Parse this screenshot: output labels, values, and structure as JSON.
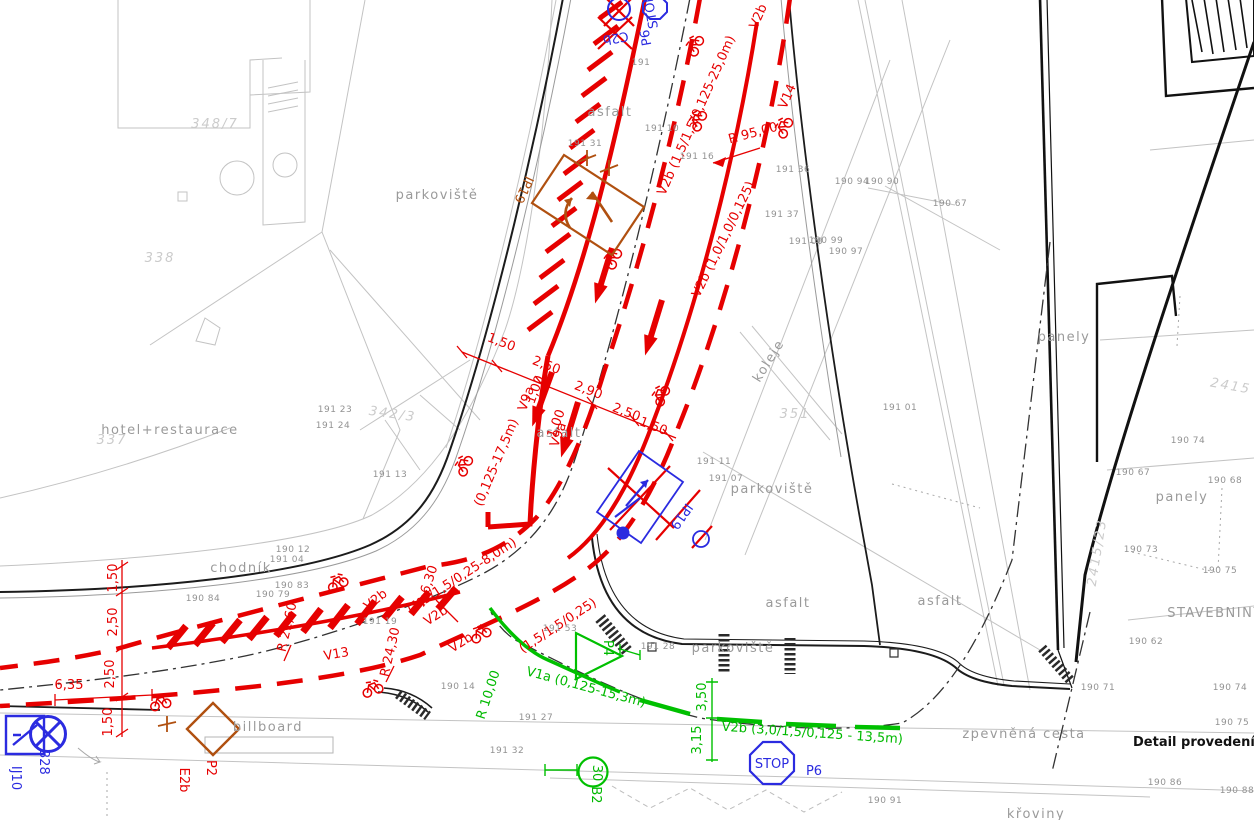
{
  "drawing": {
    "type": "traffic-engineering-situation-plan",
    "detail_note": "Detail provedení symbolu"
  },
  "colors": {
    "new_marking_red": "#e60000",
    "new_marking_green": "#00b900",
    "existing_sign_blue": "#2b2be0",
    "sign_brown": "#b05010",
    "cadastre_gray": "#9a9a9a",
    "parcel_gray": "#cbcbcb",
    "road_black": "#1c1c1c"
  },
  "labels": [
    {
      "id": "surface-chodnik",
      "text": "chodník",
      "x": 241,
      "y": 572,
      "cls": "g",
      "size": 13
    },
    {
      "id": "surface-parkoviste-1",
      "text": "parkoviště",
      "x": 437,
      "y": 199,
      "cls": "g",
      "size": 13
    },
    {
      "id": "surface-parkoviste-2",
      "text": "parkoviště",
      "x": 772,
      "y": 493,
      "cls": "g",
      "size": 13
    },
    {
      "id": "surface-parkoviste-3",
      "text": "parkoviště",
      "x": 733,
      "y": 652,
      "cls": "g",
      "size": 12
    },
    {
      "id": "surface-asfalt-1",
      "text": "asfalt",
      "x": 610,
      "y": 116,
      "cls": "g",
      "size": 13
    },
    {
      "id": "surface-asfalt-2",
      "text": "asfalt",
      "x": 559,
      "y": 437,
      "cls": "g",
      "size": 13
    },
    {
      "id": "surface-asfalt-3",
      "text": "asfalt",
      "x": 788,
      "y": 607,
      "cls": "g",
      "size": 13
    },
    {
      "id": "surface-asfalt-4",
      "text": "asfalt",
      "x": 940,
      "y": 605,
      "cls": "g",
      "size": 13
    },
    {
      "id": "surface-koleje",
      "text": "koleje",
      "x": 772,
      "y": 363,
      "rot": -58,
      "cls": "g",
      "size": 13
    },
    {
      "id": "surface-billboard",
      "text": "billboard",
      "x": 268,
      "y": 731,
      "cls": "g",
      "size": 12
    },
    {
      "id": "surface-panely-1",
      "text": "panely",
      "x": 1064,
      "y": 341,
      "cls": "g",
      "size": 12
    },
    {
      "id": "surface-panely-2",
      "text": "panely",
      "x": 1182,
      "y": 501,
      "cls": "g",
      "size": 12
    },
    {
      "id": "surface-stavebniny",
      "text": "STAVEBNINY",
      "x": 1215,
      "y": 617,
      "cls": "g",
      "size": 12
    },
    {
      "id": "surface-zpevnena-cesta",
      "text": "zpevněná cesta",
      "x": 1024,
      "y": 738,
      "cls": "g",
      "size": 13
    },
    {
      "id": "surface-kroviny",
      "text": "křoviny",
      "x": 1036,
      "y": 818,
      "cls": "g",
      "size": 13
    },
    {
      "id": "surface-hotel",
      "text": "hotel+restaurace",
      "x": 170,
      "y": 434,
      "cls": "g",
      "size": 11
    },
    {
      "id": "detail-note",
      "text": "Detail provedení symbolu",
      "x": 1133,
      "y": 746,
      "cls": "k",
      "size": 14,
      "anchor": "start"
    },
    {
      "id": "parcel-338",
      "text": "338",
      "x": 160,
      "y": 262,
      "cls": "p",
      "size": 42
    },
    {
      "id": "parcel-348-7",
      "text": "348/7",
      "x": 215,
      "y": 128,
      "cls": "p",
      "size": 42
    },
    {
      "id": "parcel-342-3",
      "text": "342/3",
      "x": 392,
      "y": 418,
      "rot": 8,
      "cls": "p",
      "size": 38
    },
    {
      "id": "parcel-337",
      "text": "337",
      "x": 112,
      "y": 444,
      "cls": "p",
      "size": 42
    },
    {
      "id": "parcel-351",
      "text": "351",
      "x": 795,
      "y": 418,
      "cls": "p",
      "size": 46
    },
    {
      "id": "parcel-2415",
      "text": "2415",
      "x": 1230,
      "y": 390,
      "rot": 10,
      "cls": "p",
      "size": 42
    },
    {
      "id": "parcel-2415-23",
      "text": "2415/23",
      "x": 1101,
      "y": 553,
      "rot": -81,
      "cls": "p",
      "size": 36
    },
    {
      "id": "mark-v2b-top",
      "text": "V2b",
      "x": 762,
      "y": 18,
      "rot": -66,
      "cls": "r",
      "size": 17
    },
    {
      "id": "mark-v14",
      "text": "V14",
      "x": 791,
      "y": 98,
      "rot": -66,
      "cls": "r",
      "size": 19
    },
    {
      "id": "dim-r95",
      "text": "R 95,00",
      "x": 754,
      "y": 137,
      "rot": -15,
      "cls": "r",
      "size": 17
    },
    {
      "id": "mark-v2b-25m",
      "text": "V2b (1,5/1,5/0,125-25,0m)",
      "x": 700,
      "y": 117,
      "rot": -66,
      "cls": "r",
      "size": 15
    },
    {
      "id": "mark-v2b-10",
      "text": "V2b (1,0/1,0/0,125)",
      "x": 727,
      "y": 241,
      "rot": -64,
      "cls": "r",
      "size": 15
    },
    {
      "id": "mark-v9a-1",
      "text": "V9a",
      "x": 530,
      "y": 400,
      "rot": -70,
      "cls": "r",
      "size": 14
    },
    {
      "id": "mark-v9a-2",
      "text": "V9a",
      "x": 562,
      "y": 436,
      "rot": -70,
      "cls": "r",
      "size": 14
    },
    {
      "id": "dim-150-a",
      "text": "1,50",
      "x": 500,
      "y": 346,
      "rot": 21,
      "cls": "r",
      "size": 15
    },
    {
      "id": "dim-250-a",
      "text": "2,50",
      "x": 545,
      "y": 369,
      "rot": 21,
      "cls": "r",
      "size": 15
    },
    {
      "id": "dim-290",
      "text": "2,90",
      "x": 587,
      "y": 394,
      "rot": 21,
      "cls": "r",
      "size": 15
    },
    {
      "id": "dim-250-b",
      "text": "2,50",
      "x": 625,
      "y": 416,
      "rot": 21,
      "cls": "r",
      "size": 15
    },
    {
      "id": "dim-150-b",
      "text": "1,50",
      "x": 652,
      "y": 430,
      "rot": 21,
      "cls": "r",
      "size": 15
    },
    {
      "id": "dim-100-a",
      "text": "1,00",
      "x": 539,
      "y": 391,
      "rot": -70,
      "cls": "r",
      "size": 11
    },
    {
      "id": "dim-100-b",
      "text": "1,00",
      "x": 560,
      "y": 425,
      "rot": -70,
      "cls": "r",
      "size": 11
    },
    {
      "id": "mark-0125-175",
      "text": "(0,125-17,5m)",
      "x": 500,
      "y": 464,
      "rot": -67,
      "cls": "r",
      "size": 15
    },
    {
      "id": "mark-v2b-8m",
      "text": "(1,5/1,5/0,25-8,0m)",
      "x": 464,
      "y": 579,
      "rot": -33,
      "cls": "r",
      "size": 15
    },
    {
      "id": "mark-v2b-a",
      "text": "V2b",
      "x": 378,
      "y": 603,
      "rot": -38,
      "cls": "r",
      "size": 16
    },
    {
      "id": "mark-v2b-b",
      "text": "V2b",
      "x": 438,
      "y": 619,
      "rot": -33,
      "cls": "r",
      "size": 16
    },
    {
      "id": "mark-v2b-c",
      "text": "V2b",
      "x": 463,
      "y": 646,
      "rot": -33,
      "cls": "r",
      "size": 16
    },
    {
      "id": "mark-v2b-d",
      "text": "(1,5/1,5/0,25)",
      "x": 560,
      "y": 629,
      "rot": -33,
      "cls": "r",
      "size": 15
    },
    {
      "id": "dim-r630",
      "text": "R 6,30",
      "x": 431,
      "y": 587,
      "rot": -72,
      "cls": "r",
      "size": 15
    },
    {
      "id": "dim-r2160",
      "text": "R 21,60",
      "x": 291,
      "y": 628,
      "rot": -77,
      "cls": "r",
      "size": 15
    },
    {
      "id": "dim-r2430",
      "text": "R 24,30",
      "x": 394,
      "y": 653,
      "rot": -77,
      "cls": "r",
      "size": 15
    },
    {
      "id": "mark-v13",
      "text": "V13",
      "x": 337,
      "y": 658,
      "rot": -10,
      "cls": "r",
      "size": 17
    },
    {
      "id": "dim-left-150-a",
      "text": "1,50",
      "x": 117,
      "y": 578,
      "rot": -90,
      "cls": "r",
      "size": 14
    },
    {
      "id": "dim-left-250-a",
      "text": "2,50",
      "x": 117,
      "y": 622,
      "rot": -90,
      "cls": "r",
      "size": 14
    },
    {
      "id": "dim-left-250-b",
      "text": "2,50",
      "x": 114,
      "y": 674,
      "rot": -90,
      "cls": "r",
      "size": 14
    },
    {
      "id": "dim-left-150-b",
      "text": "1,50",
      "x": 112,
      "y": 722,
      "rot": -90,
      "cls": "r",
      "size": 14
    },
    {
      "id": "dim-635",
      "text": "6,35",
      "x": 69,
      "y": 689,
      "cls": "r",
      "size": 15
    },
    {
      "id": "sign-p2-label",
      "text": "P2",
      "x": 207,
      "y": 768,
      "rot": 90,
      "cls": "r",
      "size": 22
    },
    {
      "id": "sign-e2b-label",
      "text": "E2b",
      "x": 180,
      "y": 780,
      "rot": 90,
      "cls": "r",
      "size": 22
    },
    {
      "id": "sign-p6-top-label",
      "text": "P6",
      "x": 650,
      "y": 37,
      "rot": -100,
      "cls": "b",
      "size": 28
    },
    {
      "id": "sign-stop-top-text",
      "text": "STOP",
      "x": 655,
      "y": 11,
      "rot": -100,
      "cls": "b",
      "size": 6
    },
    {
      "id": "sign-c2b-label-removed",
      "text": "C2b",
      "x": 615,
      "y": 34,
      "rot": 170,
      "cls": "b",
      "size": 17
    },
    {
      "id": "sign-ip19-label-removed",
      "text": "IP19",
      "x": 678,
      "y": 514,
      "rot": 125,
      "cls": "b",
      "size": 20
    },
    {
      "id": "sign-p6-label",
      "text": "P6",
      "x": 814,
      "y": 775,
      "cls": "b",
      "size": 30
    },
    {
      "id": "sign-stop-text",
      "text": "STOP",
      "x": 772,
      "y": 768,
      "cls": "b",
      "size": 10
    },
    {
      "id": "sign-b28-label",
      "text": "B28",
      "x": 40,
      "y": 762,
      "rot": 90,
      "cls": "b",
      "size": 24
    },
    {
      "id": "sign-ij10-label",
      "text": "IJ10",
      "x": 12,
      "y": 778,
      "rot": 90,
      "cls": "b",
      "size": 24
    },
    {
      "id": "dim-r1000",
      "text": "R 10,00",
      "x": 492,
      "y": 696,
      "rot": -72,
      "cls": "gr",
      "size": 15
    },
    {
      "id": "mark-v1a",
      "text": "V1a (0,125-15,3m)",
      "x": 585,
      "y": 691,
      "rot": 15,
      "cls": "gr",
      "size": 16
    },
    {
      "id": "mark-v2b-green",
      "text": "V2b (3,0/1,5/0,125 - 13,5m)",
      "x": 812,
      "y": 737,
      "rot": 4,
      "cls": "gr",
      "size": 17
    },
    {
      "id": "dim-350",
      "text": "3,50",
      "x": 706,
      "y": 697,
      "rot": -90,
      "cls": "gr",
      "size": 14
    },
    {
      "id": "dim-315",
      "text": "3,15",
      "x": 701,
      "y": 740,
      "rot": -90,
      "cls": "gr",
      "size": 14
    },
    {
      "id": "sign-p4-label",
      "text": "P4",
      "x": 604,
      "y": 648,
      "rot": 90,
      "cls": "gr",
      "size": 24
    },
    {
      "id": "sign-b2-label",
      "text": "B2",
      "x": 592,
      "y": 795,
      "rot": 90,
      "cls": "gr",
      "size": 24
    },
    {
      "id": "sign-30-text",
      "text": "30",
      "x": 593,
      "y": 773,
      "rot": 90,
      "cls": "gr",
      "size": 15
    },
    {
      "id": "sign-ip19-new-label",
      "text": "IP19",
      "x": 520,
      "y": 188,
      "rot": 115,
      "cls": "br",
      "size": 20
    },
    {
      "id": "pt",
      "text": "191",
      "x": 641,
      "y": 65,
      "cls": "n"
    },
    {
      "id": "pt",
      "text": "191 31",
      "x": 585,
      "y": 146,
      "cls": "n"
    },
    {
      "id": "pt",
      "text": "191 10",
      "x": 662,
      "y": 131,
      "cls": "n"
    },
    {
      "id": "pt",
      "text": "191 16",
      "x": 697,
      "y": 159,
      "cls": "n"
    },
    {
      "id": "pt",
      "text": "191 36",
      "x": 793,
      "y": 172,
      "cls": "n"
    },
    {
      "id": "pt",
      "text": "191 37",
      "x": 782,
      "y": 217,
      "cls": "n"
    },
    {
      "id": "pt",
      "text": "191 00",
      "x": 806,
      "y": 244,
      "cls": "n"
    },
    {
      "id": "pt",
      "text": "190 99",
      "x": 826,
      "y": 243,
      "cls": "n"
    },
    {
      "id": "pt",
      "text": "190 97",
      "x": 846,
      "y": 254,
      "cls": "n"
    },
    {
      "id": "pt",
      "text": "190 94",
      "x": 852,
      "y": 184,
      "cls": "n"
    },
    {
      "id": "pt",
      "text": "190 90",
      "x": 882,
      "y": 184,
      "cls": "n"
    },
    {
      "id": "pt",
      "text": "190 67",
      "x": 950,
      "y": 206,
      "cls": "n"
    },
    {
      "id": "pt",
      "text": "191 01",
      "x": 900,
      "y": 410,
      "cls": "n"
    },
    {
      "id": "pt",
      "text": "191 11",
      "x": 714,
      "y": 464,
      "cls": "n"
    },
    {
      "id": "pt",
      "text": "191 07",
      "x": 726,
      "y": 481,
      "cls": "n"
    },
    {
      "id": "pt",
      "text": "190 84",
      "x": 203,
      "y": 601,
      "cls": "n"
    },
    {
      "id": "pt",
      "text": "190 79",
      "x": 273,
      "y": 597,
      "cls": "n"
    },
    {
      "id": "pt",
      "text": "190 83",
      "x": 292,
      "y": 588,
      "cls": "n"
    },
    {
      "id": "pt",
      "text": "191 04",
      "x": 287,
      "y": 562,
      "cls": "n"
    },
    {
      "id": "pt",
      "text": "190 12",
      "x": 293,
      "y": 552,
      "cls": "n"
    },
    {
      "id": "pt",
      "text": "191 23",
      "x": 335,
      "y": 412,
      "cls": "n"
    },
    {
      "id": "pt",
      "text": "191 24",
      "x": 333,
      "y": 428,
      "cls": "n"
    },
    {
      "id": "pt",
      "text": "191 13",
      "x": 390,
      "y": 477,
      "cls": "n"
    },
    {
      "id": "pt",
      "text": "191 32",
      "x": 507,
      "y": 753,
      "cls": "n"
    },
    {
      "id": "pt",
      "text": "191 27",
      "x": 536,
      "y": 720,
      "cls": "n"
    },
    {
      "id": "pt",
      "text": "191 53",
      "x": 560,
      "y": 631,
      "cls": "n"
    },
    {
      "id": "pt",
      "text": "191 28",
      "x": 658,
      "y": 649,
      "cls": "n"
    },
    {
      "id": "pt",
      "text": "190 14",
      "x": 458,
      "y": 689,
      "cls": "n"
    },
    {
      "id": "pt",
      "text": "191 19",
      "x": 380,
      "y": 624,
      "cls": "n"
    },
    {
      "id": "pt",
      "text": "190 71",
      "x": 1098,
      "y": 690,
      "cls": "n"
    },
    {
      "id": "pt",
      "text": "190 74",
      "x": 1188,
      "y": 443,
      "cls": "n"
    },
    {
      "id": "pt",
      "text": "190 74",
      "x": 1230,
      "y": 690,
      "cls": "n"
    },
    {
      "id": "pt",
      "text": "190 67",
      "x": 1133,
      "y": 475,
      "cls": "n"
    },
    {
      "id": "pt",
      "text": "190 68",
      "x": 1225,
      "y": 483,
      "cls": "n"
    },
    {
      "id": "pt",
      "text": "190 73",
      "x": 1141,
      "y": 552,
      "cls": "n"
    },
    {
      "id": "pt",
      "text": "190 75",
      "x": 1220,
      "y": 573,
      "cls": "n"
    },
    {
      "id": "pt",
      "text": "190 75",
      "x": 1232,
      "y": 725,
      "cls": "n"
    },
    {
      "id": "pt",
      "text": "190 86",
      "x": 1165,
      "y": 785,
      "cls": "n"
    },
    {
      "id": "pt",
      "text": "190 88",
      "x": 1237,
      "y": 793,
      "cls": "n"
    },
    {
      "id": "pt",
      "text": "190 91",
      "x": 885,
      "y": 803,
      "cls": "n"
    },
    {
      "id": "pt",
      "text": "190 62",
      "x": 1146,
      "y": 644,
      "cls": "n"
    }
  ]
}
